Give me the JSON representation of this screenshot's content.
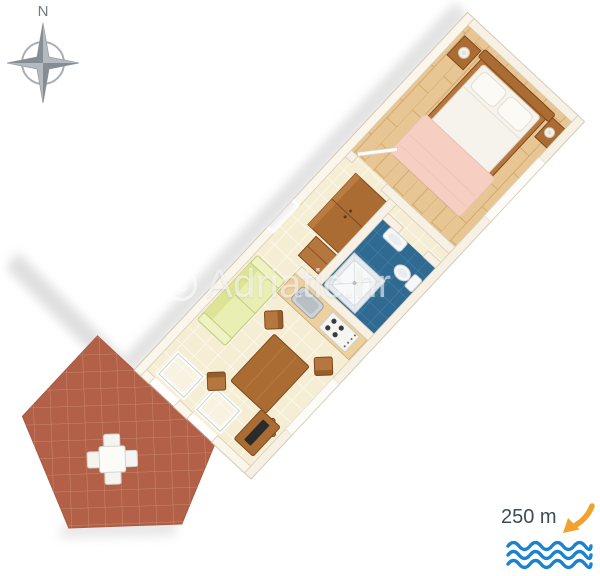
{
  "compass": {
    "north_label": "N"
  },
  "watermark": {
    "text": "Adriatic.hr"
  },
  "distance_to_sea": {
    "label": "250 m"
  },
  "colors": {
    "wall": "#f6f1e4",
    "wall_edge": "#d9cdb4",
    "floor_tile": "#f5eed4",
    "wood_floor": "#e8c694",
    "wood_line": "#d2a96d",
    "bathroom_tile": "#2e6a92",
    "bathroom_grout": "#4f84a6",
    "terrace_tile": "#b26048",
    "terrace_grout": "#c9876b",
    "sofa": "#e9efb2",
    "sofa_edge": "#c3cc82",
    "wood_furniture": "#aa6c33",
    "wood_furniture_dark": "#7c4a1e",
    "counter_wood": "#ecd09d",
    "bed_linen": "#f6f3ec",
    "bed_blanket": "#f7cfc2",
    "fixture_white": "#f5f7f8",
    "tv_black": "#2b2b2b",
    "shadow": "#d6d6d6",
    "compass_gray": "#b5bac0",
    "compass_dark": "#868c93",
    "wave_blue": "#1b82cf",
    "arrow_orange": "#f0a22e",
    "label_text": "#3e4b58",
    "watermark_white": "rgba(255,255,255,0.55)"
  }
}
